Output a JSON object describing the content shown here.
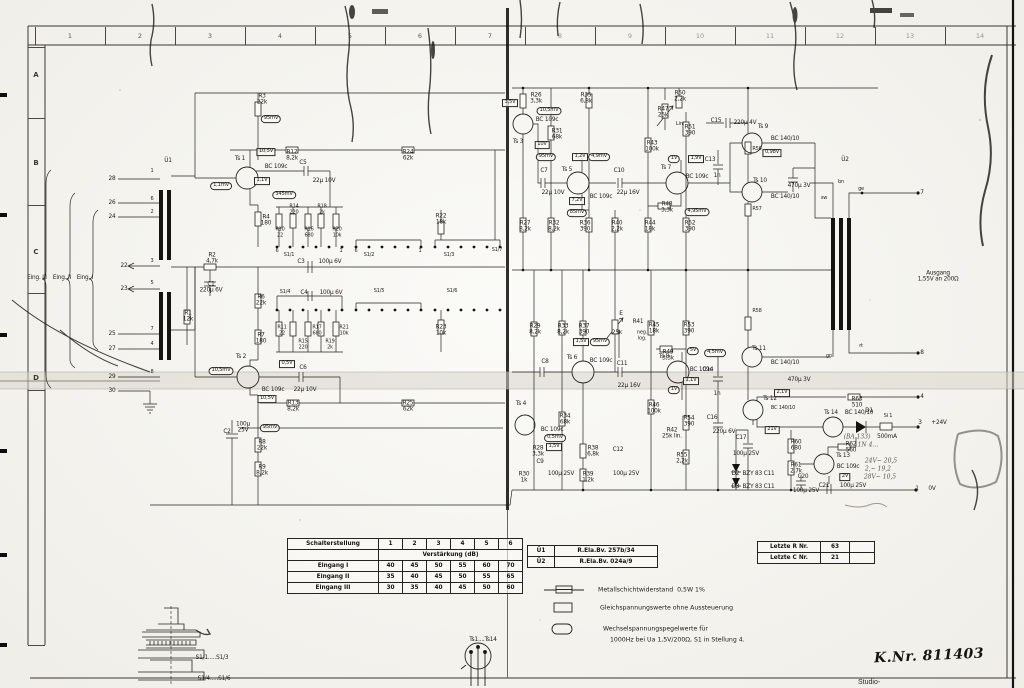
{
  "page": {
    "k_nr": "K.Nr. 811403",
    "bottom_partial_text": "Studio-"
  },
  "ruler": {
    "top": [
      "1",
      "2",
      "3",
      "4",
      "5",
      "6",
      "7",
      "8",
      "9",
      "10",
      "11",
      "12",
      "13",
      "14"
    ],
    "left": [
      "A",
      "B",
      "C",
      "D"
    ]
  },
  "gain_table": {
    "header": [
      "Schalterstellung",
      "1",
      "2",
      "3",
      "4",
      "5",
      "6"
    ],
    "subheader": "Verstärkung (dB)",
    "rows": [
      [
        "Eingang I",
        "40",
        "45",
        "50",
        "55",
        "60",
        "70"
      ],
      [
        "Eingang II",
        "35",
        "40",
        "45",
        "50",
        "55",
        "65"
      ],
      [
        "Eingang III",
        "30",
        "35",
        "40",
        "45",
        "50",
        "60"
      ]
    ]
  },
  "transformer_table": {
    "rows": [
      [
        "Ü1",
        "R.Ela.Bv. 257b/34"
      ],
      [
        "Ü2",
        "R.Ela.Bv. 024a/9"
      ]
    ]
  },
  "last_numbers_table": {
    "rows": [
      [
        "Letzte R Nr.",
        "63",
        ""
      ],
      [
        "Letzte C Nr.",
        "21",
        ""
      ]
    ]
  },
  "legend": {
    "resistor_label": "Metallschichtwiderstand  0,5W 1%",
    "dc_label": "Gleichspannungswerte ohne Aussteuerung",
    "ac_label_line1": "Wechselspannungspegelwerte für",
    "ac_label_line2": "1000Hz bei Ua 1,5V/200Ω, S1 in Stellung 4."
  },
  "drawings": {
    "rotary_switch_labels": [
      "S1/1.....S1/3",
      "S1/4.....S1/6"
    ],
    "transistor_pinout_label": "Ts1....Ts14"
  },
  "schematic": {
    "labels": [
      [
        "Ü1",
        168,
        161
      ],
      [
        "28",
        112,
        179
      ],
      [
        "26",
        112,
        203
      ],
      [
        "24",
        112,
        217
      ],
      [
        "22",
        124,
        266
      ],
      [
        "23",
        124,
        289
      ],
      [
        "25",
        112,
        334
      ],
      [
        "27",
        112,
        349
      ],
      [
        "29",
        112,
        377
      ],
      [
        "30",
        112,
        391
      ],
      [
        "Eing. III",
        37,
        278
      ],
      [
        "Eing. II",
        62,
        278
      ],
      [
        "Eing. I",
        85,
        278
      ],
      [
        "1",
        152,
        172,
        "s"
      ],
      [
        "6",
        152,
        200,
        "s"
      ],
      [
        "2",
        152,
        213,
        "s"
      ],
      [
        "3",
        152,
        262,
        "s"
      ],
      [
        "5",
        152,
        284,
        "s"
      ],
      [
        "7",
        152,
        330,
        "s"
      ],
      [
        "4",
        152,
        345,
        "s"
      ],
      [
        "8",
        152,
        373,
        "s"
      ],
      [
        "R1\n12k",
        188,
        317
      ],
      [
        "R2\n4,7k",
        212,
        259
      ],
      [
        "C1\n220μ 6V",
        211,
        288
      ],
      [
        "R3\n22k",
        262,
        100
      ],
      [
        "95mV",
        271,
        119,
        "o"
      ],
      [
        "Ts 1",
        240,
        159
      ],
      [
        "BC 109c",
        276,
        167
      ],
      [
        "10,5V",
        266,
        152,
        "b"
      ],
      [
        "1,1mV",
        221,
        186,
        "o"
      ],
      [
        "1,1V",
        262,
        181,
        "b"
      ],
      [
        "345mV",
        284,
        195,
        "o"
      ],
      [
        "R12\n8,2k",
        292,
        156
      ],
      [
        "R24\n62k",
        408,
        156
      ],
      [
        "C5",
        303,
        163
      ],
      [
        "22μ 10V",
        324,
        181
      ],
      [
        "R4\n180",
        266,
        221
      ],
      [
        "R10\n22",
        280,
        233,
        "s"
      ],
      [
        "R14\n220",
        294,
        210,
        "s"
      ],
      [
        "R16\n680",
        309,
        233,
        "s"
      ],
      [
        "R18\n2k",
        322,
        210,
        "s"
      ],
      [
        "R20\n10k",
        337,
        233,
        "s"
      ],
      [
        "R22\n18k",
        441,
        220
      ],
      [
        "S1/1",
        289,
        256,
        "s"
      ],
      [
        "S1/2",
        369,
        256,
        "s"
      ],
      [
        "S1/3",
        449,
        256,
        "s"
      ],
      [
        "S1/7",
        497,
        251,
        "s"
      ],
      [
        "6",
        277,
        252,
        "s"
      ],
      [
        "1",
        341,
        252,
        "s"
      ],
      [
        "6",
        356,
        252,
        "s"
      ],
      [
        "1",
        420,
        252,
        "s"
      ],
      [
        "C3",
        301,
        262
      ],
      [
        "100μ 6V",
        330,
        262
      ],
      [
        "S1/4",
        285,
        293,
        "s"
      ],
      [
        "C4",
        304,
        293
      ],
      [
        "100μ 6V",
        331,
        293
      ],
      [
        "S1/5",
        379,
        292,
        "s"
      ],
      [
        "S1/6",
        452,
        292,
        "s"
      ],
      [
        "R11\n22",
        282,
        331,
        "s"
      ],
      [
        "R15\n220",
        303,
        345,
        "s"
      ],
      [
        "R17\n680",
        317,
        331,
        "s"
      ],
      [
        "R19\n2k",
        330,
        345,
        "s"
      ],
      [
        "R21\n10k",
        344,
        331,
        "s"
      ],
      [
        "R23\n10k",
        441,
        331
      ],
      [
        "R6\n22k",
        261,
        301
      ],
      [
        "R7\n180",
        261,
        339
      ],
      [
        "Ts 2",
        241,
        357
      ],
      [
        "BC 109c",
        273,
        390
      ],
      [
        "10,5mV",
        221,
        371,
        "o"
      ],
      [
        "0,5V",
        287,
        364,
        "b"
      ],
      [
        "10,5V",
        267,
        399,
        "b"
      ],
      [
        "C6",
        303,
        368
      ],
      [
        "22μ 10V",
        305,
        390
      ],
      [
        "R13\n8,2k",
        293,
        407
      ],
      [
        "R25\n62k",
        408,
        407
      ],
      [
        "95mV",
        270,
        428,
        "o"
      ],
      [
        "C2",
        227,
        432
      ],
      [
        "100μ\n25V",
        243,
        428
      ],
      [
        "R8\n22k",
        262,
        446
      ],
      [
        "R9\n8,2k",
        262,
        471
      ],
      [
        "R26\n3,3k",
        536,
        99
      ],
      [
        "3,5V",
        510,
        103,
        "b"
      ],
      [
        "10,5mV",
        549,
        111,
        "o"
      ],
      [
        "BC 109c",
        547,
        120
      ],
      [
        "Ts 3",
        518,
        142
      ],
      [
        "10V",
        542,
        145,
        "b"
      ],
      [
        "95mV",
        546,
        157,
        "o"
      ],
      [
        "R31\n68k",
        557,
        135
      ],
      [
        "R35\n6,8k",
        586,
        99
      ],
      [
        "C7",
        544,
        171
      ],
      [
        "22μ 10V",
        553,
        193
      ],
      [
        "Ts 5",
        567,
        170
      ],
      [
        "1,2V",
        580,
        157,
        "b"
      ],
      [
        "4,9mV",
        599,
        157,
        "o"
      ],
      [
        "BC 109c",
        601,
        197
      ],
      [
        "7,2V",
        577,
        201,
        "b"
      ],
      [
        "85mV",
        577,
        213,
        "o"
      ],
      [
        "C10",
        619,
        171
      ],
      [
        "22μ 16V",
        628,
        193
      ],
      [
        "R43\n100k",
        652,
        147
      ],
      [
        "R47\n25k",
        663,
        113
      ],
      [
        "Lin.",
        680,
        125,
        "s"
      ],
      [
        "R50\n2,2k",
        680,
        97
      ],
      [
        "R51\n390",
        690,
        131
      ],
      [
        "Ts 7",
        666,
        168
      ],
      [
        "BC 109c",
        697,
        177
      ],
      [
        "1V",
        674,
        159,
        "o"
      ],
      [
        "1,9V",
        696,
        159,
        "b"
      ],
      [
        "R48\n3,3k",
        667,
        208
      ],
      [
        "4,95mV",
        697,
        212,
        "o"
      ],
      [
        "C13",
        710,
        160
      ],
      [
        "1n",
        717,
        176
      ],
      [
        "C15",
        716,
        121
      ],
      [
        "220μ 4V",
        745,
        123
      ],
      [
        "R27\n8,2k",
        525,
        227
      ],
      [
        "R32\n8,2k",
        554,
        227
      ],
      [
        "R36\n390",
        585,
        227
      ],
      [
        "R40\n2,2k",
        617,
        227
      ],
      [
        "R44\n18k",
        650,
        227
      ],
      [
        "R52\n390",
        690,
        227
      ],
      [
        "Ts 9",
        763,
        127
      ],
      [
        "BC 140/10",
        785,
        139
      ],
      [
        "0,98V",
        772,
        153,
        "b"
      ],
      [
        "Ts 10",
        760,
        181
      ],
      [
        "BC 140/10",
        785,
        197
      ],
      [
        "470μ 3V",
        799,
        186
      ],
      [
        "Ü2",
        845,
        160
      ],
      [
        "bn",
        841,
        183,
        "s"
      ],
      [
        "ge",
        861,
        190,
        "s"
      ],
      [
        "sw",
        824,
        199,
        "s"
      ],
      [
        "rt",
        861,
        347,
        "s"
      ],
      [
        "gn",
        829,
        357,
        "s"
      ],
      [
        "7",
        922,
        193
      ],
      [
        "8",
        922,
        353
      ],
      [
        "Ausgang\n1,55V an 200Ω",
        938,
        277
      ],
      [
        "R56",
        757,
        150,
        "s"
      ],
      [
        "R57",
        757,
        210,
        "s"
      ],
      [
        "R58",
        757,
        312,
        "s"
      ],
      [
        "R29\n8,2k",
        535,
        330
      ],
      [
        "R33\n8,2k",
        563,
        330
      ],
      [
        "R37\n390",
        584,
        330
      ],
      [
        "E",
        621,
        314
      ],
      [
        "R41",
        638,
        322
      ],
      [
        "25k",
        617,
        333
      ],
      [
        "neg.\nlog.",
        642,
        336,
        "s"
      ],
      [
        "R45\n18k",
        654,
        329
      ],
      [
        "R53\n390",
        689,
        329
      ],
      [
        "1,5V",
        581,
        342,
        "b"
      ],
      [
        "95mV",
        600,
        342,
        "o"
      ],
      [
        "R49\n3,3k",
        668,
        356
      ],
      [
        "Ts 6",
        572,
        358
      ],
      [
        "BC 109c",
        601,
        361
      ],
      [
        "C8",
        545,
        362
      ],
      [
        "C11",
        622,
        364
      ],
      [
        "22μ 16V",
        629,
        386
      ],
      [
        "Ts 8",
        664,
        357
      ],
      [
        "BC 109c",
        701,
        370
      ],
      [
        "5V",
        693,
        351,
        "o"
      ],
      [
        "4,5mV",
        715,
        353,
        "o"
      ],
      [
        "1,1V",
        691,
        381,
        "b"
      ],
      [
        "1V",
        674,
        390,
        "o"
      ],
      [
        "C14",
        708,
        370
      ],
      [
        "1n",
        717,
        394
      ],
      [
        "R46\n100k",
        654,
        409
      ],
      [
        "Ts 4",
        521,
        404
      ],
      [
        "BC 109c",
        552,
        430
      ],
      [
        "0,5mV",
        555,
        438,
        "o"
      ],
      [
        "1,5V",
        554,
        447,
        "b"
      ],
      [
        "R28\n3,3k",
        538,
        452
      ],
      [
        "C9",
        540,
        462
      ],
      [
        "100μ 25V",
        561,
        474
      ],
      [
        "R30\n1k",
        524,
        478
      ],
      [
        "R34\n68k",
        565,
        420
      ],
      [
        "R38\n6,8k",
        593,
        452
      ],
      [
        "R39\n1,2k",
        588,
        478
      ],
      [
        "C12",
        618,
        450
      ],
      [
        "100μ 25V",
        626,
        474
      ],
      [
        "R54\n390",
        689,
        422
      ],
      [
        "R42\n25k lin.",
        672,
        434
      ],
      [
        "R55\n2,2k",
        682,
        459
      ],
      [
        "C16",
        712,
        418
      ],
      [
        "220μ 6V",
        724,
        432
      ],
      [
        "Ts 11",
        759,
        349
      ],
      [
        "BC 140/10",
        785,
        363
      ],
      [
        "470μ 3V",
        799,
        380
      ],
      [
        "R63\n510",
        857,
        403
      ],
      [
        "4",
        922,
        397
      ],
      [
        "Ts 12",
        770,
        399
      ],
      [
        "BC 140/10",
        783,
        409,
        "s"
      ],
      [
        "2,1V",
        782,
        393,
        "b"
      ],
      [
        "21V",
        772,
        430,
        "b"
      ],
      [
        "Ts 14",
        831,
        413
      ],
      [
        "BC 140/10",
        859,
        413
      ],
      [
        "D1",
        869,
        411
      ],
      [
        "Si 1",
        888,
        417,
        "s"
      ],
      [
        "3",
        920,
        423
      ],
      [
        "+24V",
        939,
        423
      ],
      [
        "(BA 133)",
        857,
        438,
        "h"
      ],
      [
        "500mA",
        887,
        437
      ],
      [
        "1N 4…",
        868,
        446,
        "h"
      ],
      [
        "C17",
        741,
        438
      ],
      [
        "100μ 25V",
        746,
        454
      ],
      [
        "R60\n680",
        796,
        446
      ],
      [
        "R61\n2,7k",
        796,
        469
      ],
      [
        "C20",
        803,
        477
      ],
      [
        "100μ 25V",
        806,
        491
      ],
      [
        "D2  BZY 83 C11",
        753,
        474
      ],
      [
        "D3  BZY 83 C11",
        753,
        487
      ],
      [
        "Ts 13",
        843,
        456
      ],
      [
        "BC 109c",
        848,
        467
      ],
      [
        "2V",
        845,
        477,
        "b"
      ],
      [
        "R62\n560",
        851,
        448
      ],
      [
        "C21",
        824,
        486
      ],
      [
        "100μ 25V",
        853,
        486
      ],
      [
        "1",
        917,
        489
      ],
      [
        "0V",
        932,
        489
      ],
      [
        "24V~ 20,5",
        881,
        462,
        "h"
      ],
      [
        "2,~ 19,2",
        878,
        470,
        "h"
      ],
      [
        "28V~ 10,5",
        880,
        478,
        "h"
      ],
      [
        "S1/1.....S1/3",
        212,
        658
      ],
      [
        "S1/4.....S1/6",
        214,
        679
      ],
      [
        "Ts1....Ts14",
        483,
        640
      ]
    ]
  }
}
